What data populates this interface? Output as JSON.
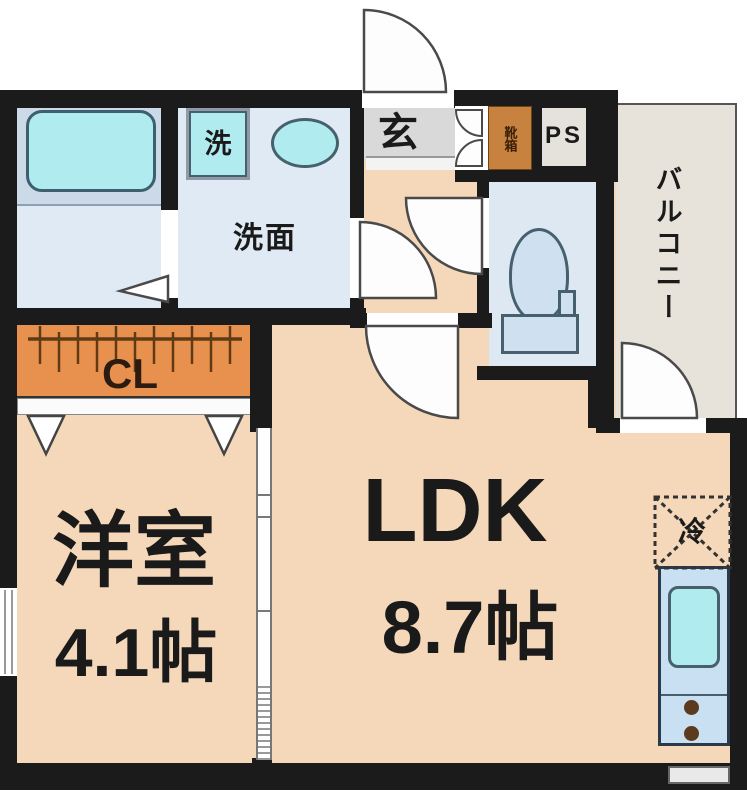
{
  "floor_plan": {
    "rooms": {
      "ldk": {
        "label": "LDK",
        "size": "8.7帖"
      },
      "western_room": {
        "label": "洋室",
        "size": "4.1帖"
      },
      "closet": {
        "label": "CL"
      },
      "washroom": {
        "label": "洗面"
      },
      "washing_machine": {
        "label": "洗"
      },
      "entrance": {
        "label": "玄"
      },
      "shoe_cabinet": {
        "label": "靴箱"
      },
      "pipe_space": {
        "label": "PS"
      },
      "balcony": {
        "label": "バルコニー"
      },
      "refrigerator": {
        "label": "冷"
      }
    },
    "colors": {
      "wall": "#1b1b1b",
      "floor_main": "#f5d8ba",
      "floor_wet": "#e0eaf4",
      "bath_upper": "#ccdae8",
      "fixture_cyan": "#b0ebf0",
      "closet_orange": "#e8914e",
      "shoe_cabinet_orange": "#c8823f",
      "balcony_beige": "#e7e2da",
      "entrance_gray": "#d9d9d9",
      "kitchen_counter_blue": "#c9e0f2"
    }
  }
}
